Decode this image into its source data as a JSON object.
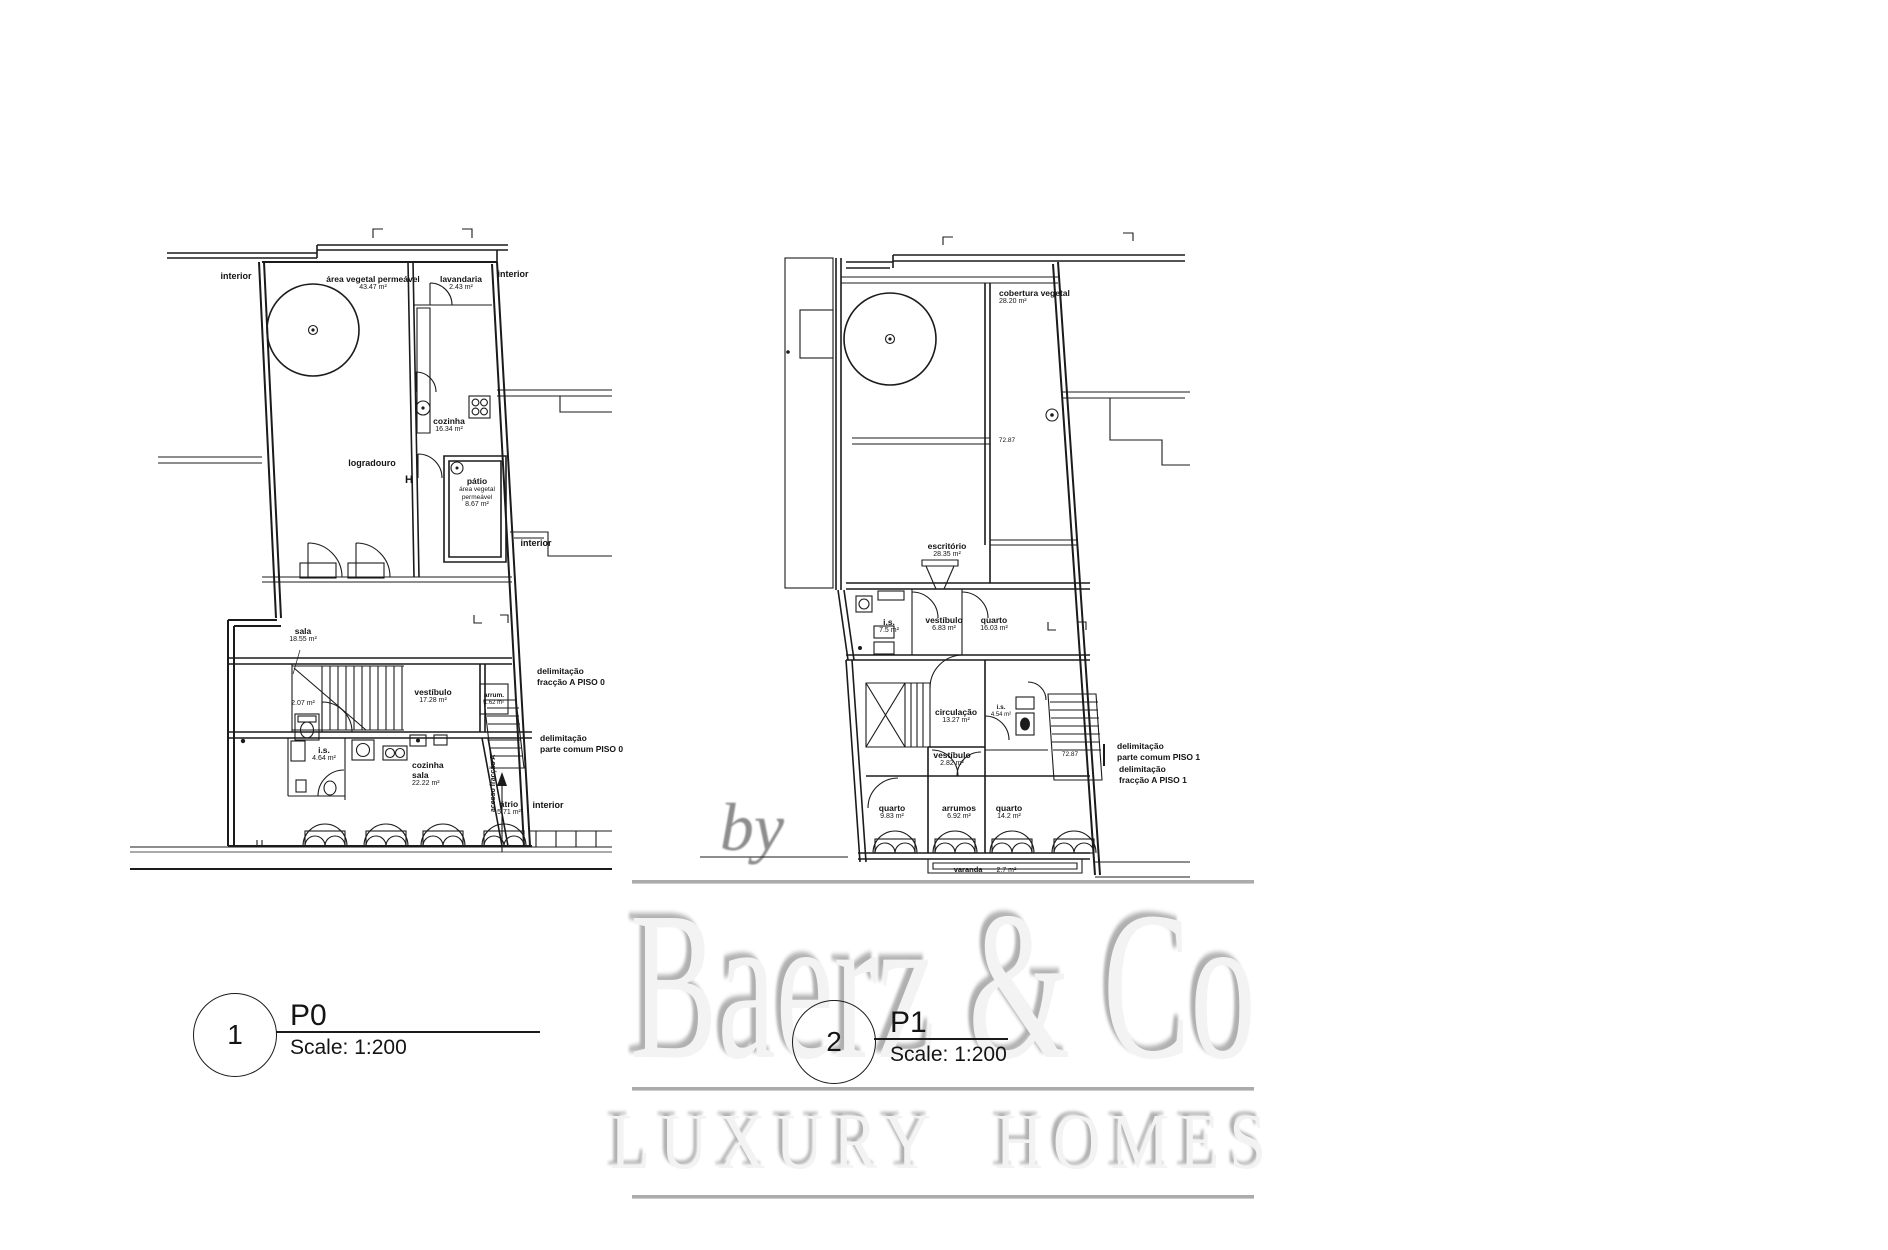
{
  "watermark": {
    "by": "by",
    "brand": "Baerz & Co",
    "tagline": "LUXURY HOMES"
  },
  "legends": [
    {
      "number": "1",
      "title": "P0",
      "scale": "Scale: 1:200"
    },
    {
      "number": "2",
      "title": "P1",
      "scale": "Scale: 1:200"
    }
  ],
  "p0": {
    "title": "Floor plan P0",
    "labels": [
      {
        "name": "interior"
      },
      {
        "name": "área vegetal permeável",
        "area": "43.47 m²"
      },
      {
        "name": "lavandaria",
        "area": "2.43 m²"
      },
      {
        "name": "interior"
      },
      {
        "name": "cozinha",
        "area": "16.34 m²"
      },
      {
        "name": "logradouro"
      },
      {
        "name": "pátio",
        "sub": "área vegetal permeável",
        "area": "8.67 m²"
      },
      {
        "name": "interior"
      },
      {
        "name": "sala",
        "area": "18.55 m²"
      },
      {
        "area": "2.07 m²"
      },
      {
        "name": "vestíbulo",
        "area": "17.28 m²"
      },
      {
        "name": "i.s.",
        "area": "4.64 m²"
      },
      {
        "name": "cozinha sala",
        "area": "22.22 m²"
      },
      {
        "name": "átrio",
        "area": "5.71 m²"
      },
      {
        "name": "interior"
      },
      {
        "line1": "delimitação",
        "line2": "fracção A PISO 0"
      },
      {
        "line1": "delimitação",
        "line2": "parte comum PISO 0"
      },
      {
        "name": "arrum.",
        "area": "1.62 m²"
      },
      {
        "name": "acesso fracção A"
      },
      {
        "name": "H"
      }
    ]
  },
  "p1": {
    "title": "Floor plan P1",
    "labels": [
      {
        "name": "cobertura vegetal",
        "area": "28.20 m²"
      },
      {
        "name": "72.87"
      },
      {
        "name": "escritório",
        "area": "28.35 m²"
      },
      {
        "name": "i.s.",
        "area": "7.5 m²"
      },
      {
        "name": "vestíbulo",
        "area": "6.83 m²"
      },
      {
        "name": "quarto",
        "area": "16.03 m²"
      },
      {
        "name": "circulação",
        "area": "13.27 m²"
      },
      {
        "name": "i.s.",
        "area": "4.54 m²"
      },
      {
        "name": "vestíbulo",
        "area": "2.82 m²"
      },
      {
        "name": "quarto",
        "area": "9.83 m²"
      },
      {
        "name": "arrumos",
        "area": "6.92 m²"
      },
      {
        "name": "quarto",
        "area": "14.2 m²"
      },
      {
        "name": "varanda",
        "area": "2.7 m²"
      },
      {
        "name": "72.87"
      },
      {
        "line1": "delimitação",
        "line2": "parte comum PISO 1"
      },
      {
        "line1": "delimitação",
        "line2": "fracção A PISO 1"
      }
    ]
  }
}
